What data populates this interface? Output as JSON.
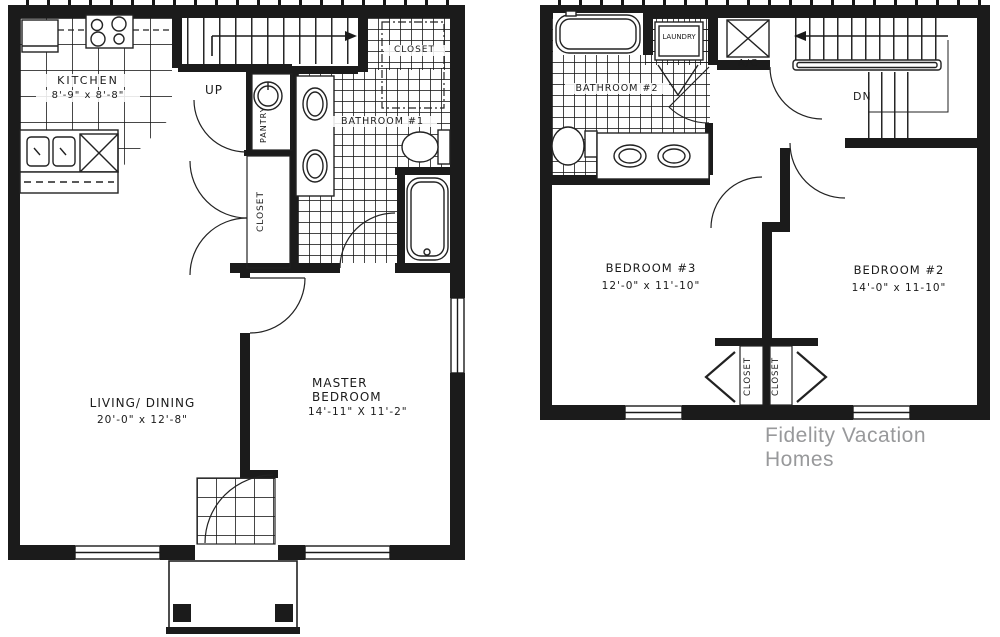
{
  "watermark": "Fidelity Vacation Homes",
  "colors": {
    "ink": "#1b1b1b",
    "watermark_text": "#98999b"
  },
  "first_floor": {
    "kitchen": {
      "name": "KITCHEN",
      "dims": "8'-9\" x 8'-8\""
    },
    "stairs_label": "UP",
    "pantry_label": "PANTRY",
    "hall_closet_label": "CLOSET",
    "bath_closet_label": "CLOSET",
    "bathroom_label": "BATHROOM #1",
    "living": {
      "name": "LIVING/ DINING",
      "dims": "20'-0\" x 12'-8\""
    },
    "master": {
      "name": "MASTER BEDROOM",
      "dims": "14'-11\" X 11'-2\""
    }
  },
  "second_floor": {
    "bathroom_label": "BATHROOM #2",
    "laundry_label": "LAUNDRY",
    "ac_label": "A/C",
    "stairs_label": "DN",
    "bedroom3": {
      "name": "BEDROOM #3",
      "dims": "12'-0\" x 11'-10\""
    },
    "bedroom2": {
      "name": "BEDROOM #2",
      "dims": "14'-0\" x 11-10\""
    },
    "closet_left_label": "CLOSET",
    "closet_right_label": "CLOSET"
  }
}
